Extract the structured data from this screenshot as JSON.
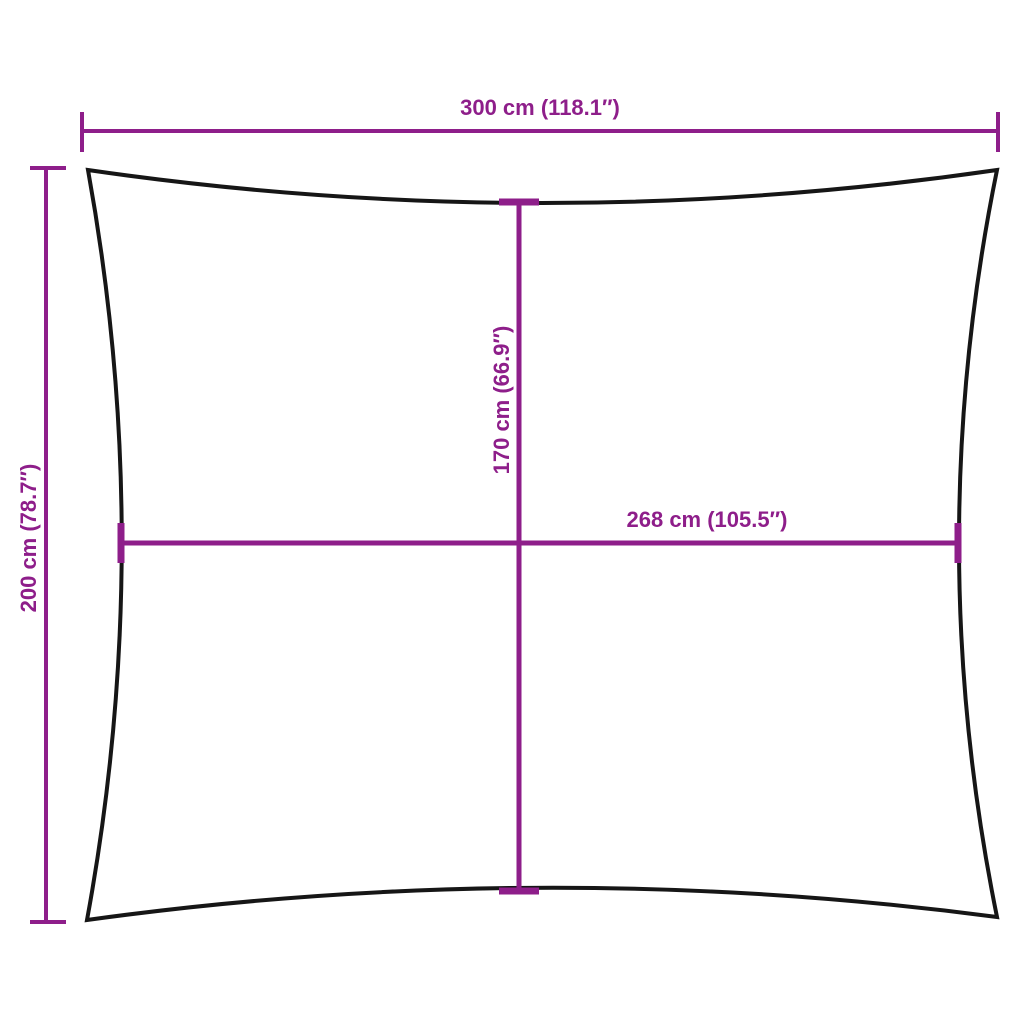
{
  "diagram": {
    "type": "product-dimension-diagram",
    "shape": "shade-sail-rectangle-outline",
    "labels": {
      "top_width": "300 cm (118.1″)",
      "left_height": "200 cm (78.7″)",
      "inner_height": "170 cm (66.9″)",
      "inner_width": "268 cm (105.5″)"
    },
    "colors": {
      "dimension_accent": "#8E1E8A",
      "outline": "#161616",
      "background": "#FFFFFF"
    }
  }
}
